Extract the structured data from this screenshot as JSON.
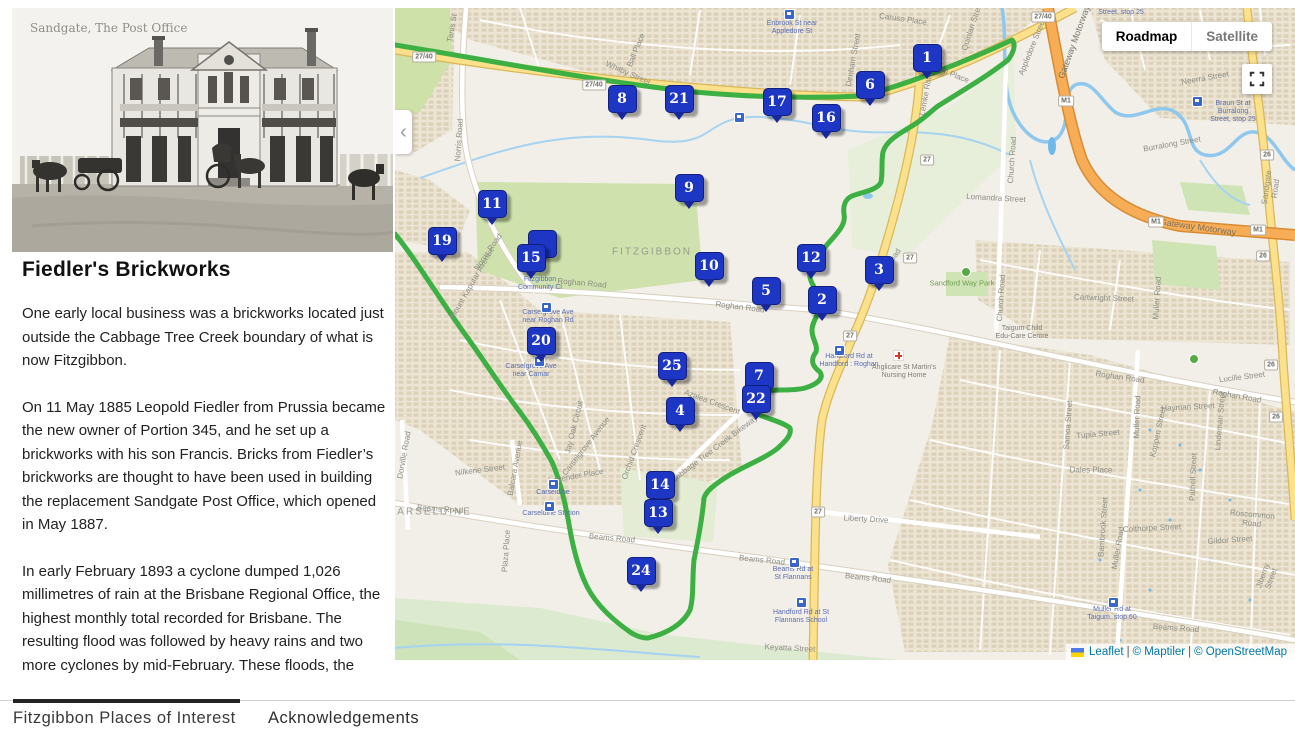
{
  "sidebar": {
    "photo_caption": "Sandgate, The Post Office",
    "title": "Fiedler's Brickworks",
    "paragraphs": [
      "One early local business was a brickworks located just outside the Cabbage Tree Creek boundary of what is now Fitzgibbon.",
      "On 11 May 1885 Leopold Fiedler from Prussia became the new owner of Portion 345, and he set up a brickworks with his son Francis. Bricks from Fiedler’s brickworks are thought to have been used in building the replacement Sandgate Post Office, which opened in May 1887.",
      "In early February 1893 a cyclone dumped 1,026 millimetres of rain at the Brisbane Regional Office, the highest monthly total recorded for Brisbane. The resulting flood was followed by heavy rains and two more cyclones by mid-February. These floods, the"
    ]
  },
  "map": {
    "controls": {
      "roadmap": "Roadmap",
      "satellite": "Satellite"
    },
    "attribution": {
      "leaflet": "Leaflet",
      "maptiler": "© Maptiler",
      "osm": "© OpenStreetMap",
      "sep": "|"
    },
    "colors": {
      "marker_blue": "#1d36c4",
      "route_green": "#3cb043",
      "link_blue": "#0078a8"
    },
    "markers": [
      {
        "n": "1",
        "x": 926,
        "y": 57
      },
      {
        "n": "6",
        "x": 869,
        "y": 84
      },
      {
        "n": "8",
        "x": 621,
        "y": 98
      },
      {
        "n": "21",
        "x": 678,
        "y": 98
      },
      {
        "n": "17",
        "x": 776,
        "y": 101
      },
      {
        "n": "16",
        "x": 825,
        "y": 117
      },
      {
        "n": "9",
        "x": 688,
        "y": 187
      },
      {
        "n": "11",
        "x": 491,
        "y": 203
      },
      {
        "n": "19",
        "x": 441,
        "y": 240
      },
      {
        "n": "",
        "x": 541,
        "y": 243
      },
      {
        "n": "15",
        "x": 530,
        "y": 257
      },
      {
        "n": "10",
        "x": 708,
        "y": 265
      },
      {
        "n": "12",
        "x": 810,
        "y": 257
      },
      {
        "n": "3",
        "x": 878,
        "y": 269
      },
      {
        "n": "5",
        "x": 765,
        "y": 290
      },
      {
        "n": "2",
        "x": 821,
        "y": 299
      },
      {
        "n": "20",
        "x": 540,
        "y": 340
      },
      {
        "n": "25",
        "x": 671,
        "y": 365
      },
      {
        "n": "7",
        "x": 758,
        "y": 375
      },
      {
        "n": "22",
        "x": 755,
        "y": 398
      },
      {
        "n": "4",
        "x": 679,
        "y": 410
      },
      {
        "n": "14",
        "x": 659,
        "y": 484
      },
      {
        "n": "13",
        "x": 657,
        "y": 512
      },
      {
        "n": "24",
        "x": 640,
        "y": 570
      }
    ],
    "labels": [
      {
        "t": "Tanis St",
        "x": 452,
        "y": 28,
        "r": -80,
        "c": "st"
      },
      {
        "t": "Norris Road",
        "x": 459,
        "y": 140,
        "r": -86,
        "c": "st"
      },
      {
        "t": "Norris Road",
        "x": 488,
        "y": 252,
        "r": -55,
        "c": "st"
      },
      {
        "t": "Whitby Street",
        "x": 628,
        "y": 73,
        "r": 24,
        "c": "st"
      },
      {
        "t": "Ball Place",
        "x": 636,
        "y": 50,
        "r": -68,
        "c": "st"
      },
      {
        "t": "Caruso Place",
        "x": 903,
        "y": 19,
        "r": 8,
        "c": "st"
      },
      {
        "t": "Pilgrim Place",
        "x": 947,
        "y": 72,
        "r": 22,
        "c": "st"
      },
      {
        "t": "Appledore Street",
        "x": 1032,
        "y": 47,
        "r": -68,
        "c": "st"
      },
      {
        "t": "Denham Street",
        "x": 853,
        "y": 60,
        "r": -80,
        "c": "st"
      },
      {
        "t": "Quinlan Street",
        "x": 972,
        "y": 26,
        "r": -72,
        "c": "st"
      },
      {
        "t": "Lemke Road",
        "x": 926,
        "y": 93,
        "r": -80,
        "c": "st"
      },
      {
        "t": "Lemke Road",
        "x": 886,
        "y": 268,
        "r": -55,
        "c": "st"
      },
      {
        "t": "Roghan Road",
        "x": 582,
        "y": 283,
        "r": 5,
        "c": "st"
      },
      {
        "t": "Roghan Road",
        "x": 740,
        "y": 307,
        "r": 7,
        "c": "st"
      },
      {
        "t": "Roghan Road",
        "x": 1120,
        "y": 377,
        "r": 8,
        "c": "st"
      },
      {
        "t": "Roghan Road",
        "x": 1237,
        "y": 396,
        "r": 10,
        "c": "st"
      },
      {
        "t": "Lucille Street",
        "x": 1242,
        "y": 377,
        "r": -7,
        "c": "st"
      },
      {
        "t": "Lomandra Street",
        "x": 996,
        "y": 198,
        "r": 3,
        "c": "st"
      },
      {
        "t": "Church Road",
        "x": 1012,
        "y": 160,
        "r": -86,
        "c": "st"
      },
      {
        "t": "Church Road",
        "x": 1001,
        "y": 298,
        "r": -86,
        "c": "st"
      },
      {
        "t": "Sandgate Road",
        "x": 1271,
        "y": 188,
        "r": -82,
        "c": "st"
      },
      {
        "t": "Burralong Street",
        "x": 1172,
        "y": 144,
        "r": -10,
        "c": "st"
      },
      {
        "t": "Neerra Street",
        "x": 1205,
        "y": 78,
        "r": -10,
        "c": "st"
      },
      {
        "t": "Cartwright Street",
        "x": 1104,
        "y": 298,
        "r": 2,
        "c": "st"
      },
      {
        "t": "Muller Road",
        "x": 1157,
        "y": 298,
        "r": -86,
        "c": "st"
      },
      {
        "t": "Muller Road",
        "x": 1137,
        "y": 417,
        "r": -88,
        "c": "st"
      },
      {
        "t": "Muller Road",
        "x": 1118,
        "y": 548,
        "r": -80,
        "c": "st"
      },
      {
        "t": "Hayman Street",
        "x": 1188,
        "y": 407,
        "r": -3,
        "c": "st"
      },
      {
        "t": "Samoa Street",
        "x": 1068,
        "y": 425,
        "r": -86,
        "c": "st"
      },
      {
        "t": "Tupia Street",
        "x": 1098,
        "y": 434,
        "r": -5,
        "c": "st"
      },
      {
        "t": "Dales Place",
        "x": 1091,
        "y": 470,
        "r": 0,
        "c": "st"
      },
      {
        "t": "Koppen Street",
        "x": 1158,
        "y": 432,
        "r": -78,
        "c": "st"
      },
      {
        "t": "Lindeman Street",
        "x": 1220,
        "y": 421,
        "r": -85,
        "c": "st"
      },
      {
        "t": "Pathell Street",
        "x": 1193,
        "y": 477,
        "r": -88,
        "c": "st"
      },
      {
        "t": "Roscommon Road",
        "x": 1252,
        "y": 519,
        "r": 5,
        "c": "st"
      },
      {
        "t": "Colthorpe Street",
        "x": 1152,
        "y": 528,
        "r": -3,
        "c": "st"
      },
      {
        "t": "Gildor Street",
        "x": 1230,
        "y": 540,
        "r": -4,
        "c": "st"
      },
      {
        "t": "Bambrook Street",
        "x": 1103,
        "y": 527,
        "r": -86,
        "c": "st"
      },
      {
        "t": "Jiberny Street",
        "x": 1267,
        "y": 577,
        "r": -70,
        "c": "st"
      },
      {
        "t": "Beams Road",
        "x": 1176,
        "y": 628,
        "r": 4,
        "c": "st"
      },
      {
        "t": "Beams Road",
        "x": 612,
        "y": 538,
        "r": 5,
        "c": "st"
      },
      {
        "t": "Beams Road",
        "x": 762,
        "y": 560,
        "r": 6,
        "c": "st"
      },
      {
        "t": "Beams Road",
        "x": 868,
        "y": 578,
        "r": 6,
        "c": "st"
      },
      {
        "t": "Beams Road",
        "x": 440,
        "y": 509,
        "r": 4,
        "c": "st"
      },
      {
        "t": "Liberty Drive",
        "x": 866,
        "y": 519,
        "r": 3,
        "c": "st"
      },
      {
        "t": "Keyatta Street",
        "x": 790,
        "y": 648,
        "r": 3,
        "c": "st"
      },
      {
        "t": "Nilkerie Street",
        "x": 480,
        "y": 470,
        "r": -7,
        "c": "st"
      },
      {
        "t": "Balcara Avenue",
        "x": 515,
        "y": 468,
        "r": -80,
        "c": "st"
      },
      {
        "t": "Dorville Road",
        "x": 404,
        "y": 455,
        "r": -80,
        "c": "st"
      },
      {
        "t": "Plaza Place",
        "x": 506,
        "y": 551,
        "r": -86,
        "c": "st"
      },
      {
        "t": "Lavender Place",
        "x": 576,
        "y": 476,
        "r": -10,
        "c": "st"
      },
      {
        "t": "Carselgrove Avenue",
        "x": 586,
        "y": 446,
        "r": -52,
        "c": "st"
      },
      {
        "t": "Orchid Crescent",
        "x": 634,
        "y": 452,
        "r": -70,
        "c": "st"
      },
      {
        "t": "Jay Oak Circuit",
        "x": 574,
        "y": 427,
        "r": -76,
        "c": "st"
      },
      {
        "t": "Azalea Crescent",
        "x": 712,
        "y": 402,
        "r": 20,
        "c": "st"
      },
      {
        "t": "Cabbage Tree Creek Bikeway",
        "x": 714,
        "y": 449,
        "r": -37,
        "c": "st"
      },
      {
        "t": "Mount Kaputar Avenue",
        "x": 472,
        "y": 283,
        "r": -60,
        "c": "st"
      },
      {
        "t": "Gateway Motorway",
        "x": 1198,
        "y": 227,
        "r": 8,
        "c": "mwy"
      },
      {
        "t": "Gateway Motorway",
        "x": 1074,
        "y": 42,
        "r": -70,
        "c": "mwy"
      },
      {
        "t": "FITZGIBBON",
        "x": 652,
        "y": 252,
        "r": 0,
        "c": "place"
      },
      {
        "t": "CARSELDINE",
        "x": 430,
        "y": 512,
        "r": 0,
        "c": "place"
      },
      {
        "t": "Enbrook St near\nAppledore St",
        "x": 792,
        "y": 28,
        "r": 0,
        "c": "bus"
      },
      {
        "t": "Braun St at Burralong\nStreet, stop 25",
        "x": 1233,
        "y": 112,
        "r": 0,
        "c": "bus"
      },
      {
        "t": "Street, stop 25",
        "x": 1121,
        "y": 13,
        "r": 0,
        "c": "bus"
      },
      {
        "t": "Fitzgibbon\nCommunity Cl",
        "x": 540,
        "y": 284,
        "r": 0,
        "c": "bus"
      },
      {
        "t": "Carselgrove Ave\nnear Roghan Rd",
        "x": 548,
        "y": 317,
        "r": 0,
        "c": "bus"
      },
      {
        "t": "Carselgrove Ave\nnear Camar",
        "x": 531,
        "y": 371,
        "r": 0,
        "c": "bus"
      },
      {
        "t": "Carseldine",
        "x": 553,
        "y": 493,
        "r": 0,
        "c": "bus"
      },
      {
        "t": "Carseldine Station",
        "x": 551,
        "y": 514,
        "r": 0,
        "c": "bus"
      },
      {
        "t": "Handford Rd at\nHandford : Roghan",
        "x": 849,
        "y": 361,
        "r": 0,
        "c": "bus"
      },
      {
        "t": "Beams Rd at\nSt Flannans",
        "x": 793,
        "y": 574,
        "r": 0,
        "c": "bus"
      },
      {
        "t": "Handford Rd at St\nFlannans School",
        "x": 801,
        "y": 617,
        "r": 0,
        "c": "bus"
      },
      {
        "t": "Muller Rd at\nTaigum, stop 60",
        "x": 1112,
        "y": 614,
        "r": 0,
        "c": "bus"
      },
      {
        "t": "Anglicare St Martin's\nNursing Home",
        "x": 904,
        "y": 372,
        "r": 0,
        "c": "poi"
      },
      {
        "t": "Taigum Child\nEdu-Care Centre",
        "x": 1022,
        "y": 333,
        "r": 0,
        "c": "poi"
      },
      {
        "t": "Sandford Way Park",
        "x": 962,
        "y": 283,
        "r": 0,
        "c": "park"
      }
    ],
    "shields": [
      {
        "t": "27/40",
        "x": 1043,
        "y": 17
      },
      {
        "t": "27/40",
        "x": 424,
        "y": 57
      },
      {
        "t": "27/40",
        "x": 594,
        "y": 85
      },
      {
        "t": "M1",
        "x": 1066,
        "y": 101
      },
      {
        "t": "M1",
        "x": 1156,
        "y": 222
      },
      {
        "t": "M1",
        "x": 1258,
        "y": 230
      },
      {
        "t": "26",
        "x": 1267,
        "y": 155
      },
      {
        "t": "26",
        "x": 1263,
        "y": 256
      },
      {
        "t": "26",
        "x": 1271,
        "y": 365
      },
      {
        "t": "26",
        "x": 1276,
        "y": 417
      },
      {
        "t": "27",
        "x": 927,
        "y": 160
      },
      {
        "t": "27",
        "x": 910,
        "y": 258
      },
      {
        "t": "27",
        "x": 850,
        "y": 336
      },
      {
        "t": "27",
        "x": 818,
        "y": 512
      }
    ],
    "bus_icons": [
      {
        "x": 788,
        "y": 13
      },
      {
        "x": 738,
        "y": 116
      },
      {
        "x": 545,
        "y": 306
      },
      {
        "x": 538,
        "y": 360
      },
      {
        "x": 552,
        "y": 483
      },
      {
        "x": 548,
        "y": 505
      },
      {
        "x": 838,
        "y": 349
      },
      {
        "x": 793,
        "y": 561
      },
      {
        "x": 800,
        "y": 601
      },
      {
        "x": 1112,
        "y": 601
      },
      {
        "x": 1196,
        "y": 100
      }
    ],
    "tree_icons": [
      {
        "x": 965,
        "y": 271
      },
      {
        "x": 1193,
        "y": 358
      }
    ],
    "hospital_icons": [
      {
        "x": 897,
        "y": 354
      }
    ]
  },
  "tabs": [
    {
      "label": "Fitzgibbon Places of Interest",
      "active": true
    },
    {
      "label": "Acknowledgements",
      "active": false
    }
  ]
}
